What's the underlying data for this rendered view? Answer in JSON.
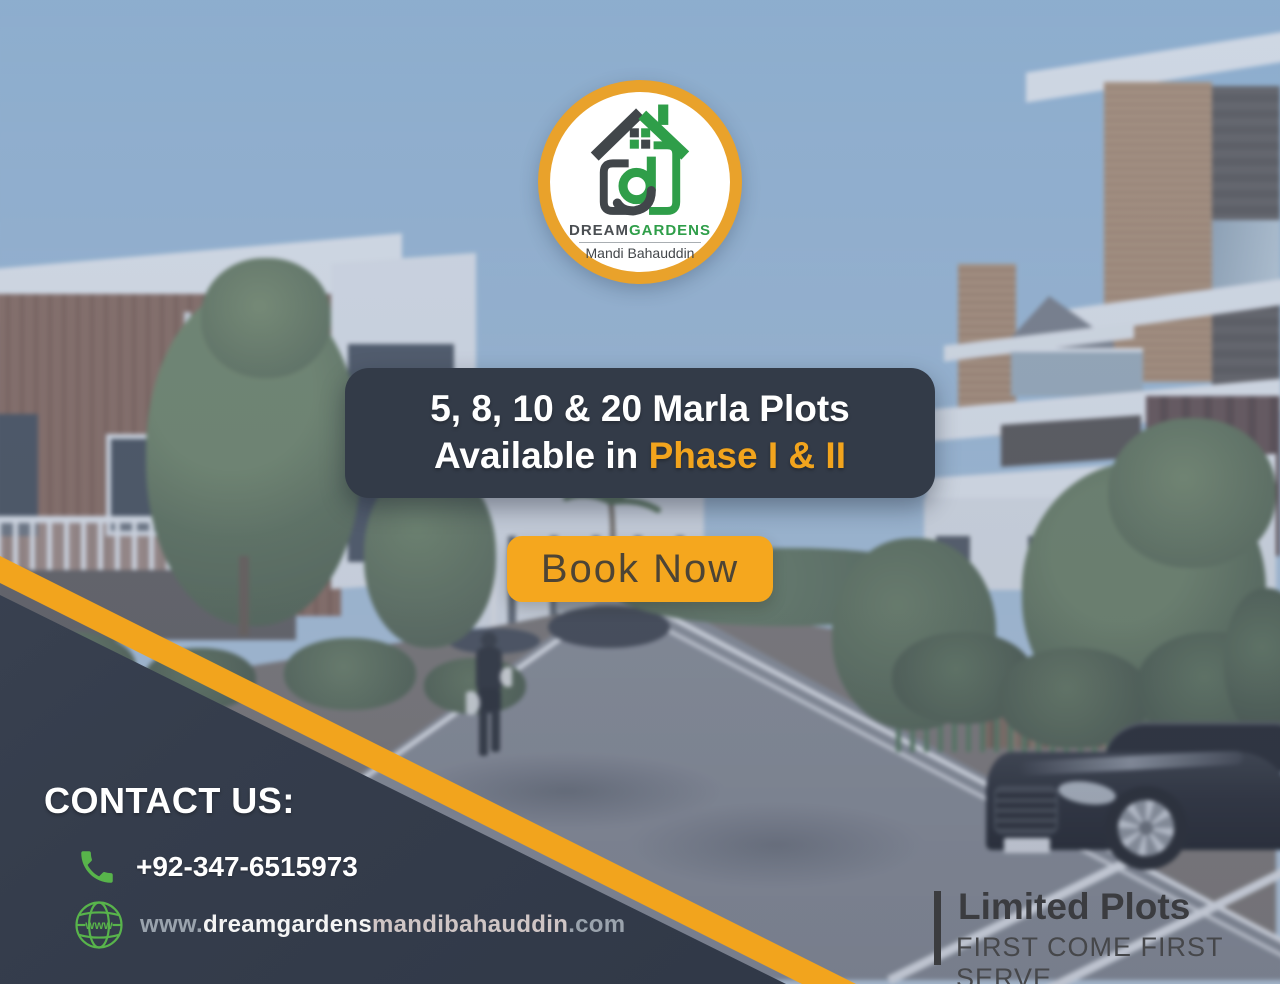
{
  "brand": {
    "name_primary": "DREAM",
    "name_secondary": "GARDENS",
    "tagline": "Mandi Bahauddin"
  },
  "banner": {
    "line1": "5, 8, 10 & 20 Marla Plots",
    "line2_prefix": "Available in ",
    "line2_highlight": "Phase I & II"
  },
  "cta": {
    "label": "Book Now"
  },
  "contact": {
    "heading": "CONTACT US:",
    "phone": "+92-347-6515973",
    "website_www": "www.",
    "website_name": "dreamgardens",
    "website_mid": "mandibahauddin",
    "website_tld": ".com",
    "globe_label": "www"
  },
  "footer_note": {
    "title": "Limited Plots",
    "subtitle": "FIRST COME FIRST SERVE"
  },
  "icons": {
    "logo": "house-monogram-icon",
    "phone": "phone-icon",
    "globe": "globe-www-icon"
  },
  "colors": {
    "accent_orange": "#F2A41D",
    "ring_gold": "#E9A22B",
    "panel_navy": "#353D4C",
    "banner_dark": "#333B48",
    "logo_green": "#2F9E49",
    "logo_dark": "#41464A",
    "icon_green": "#58B44B",
    "cta_text": "#4D4435",
    "sky_blue": "#8FB9DC"
  }
}
